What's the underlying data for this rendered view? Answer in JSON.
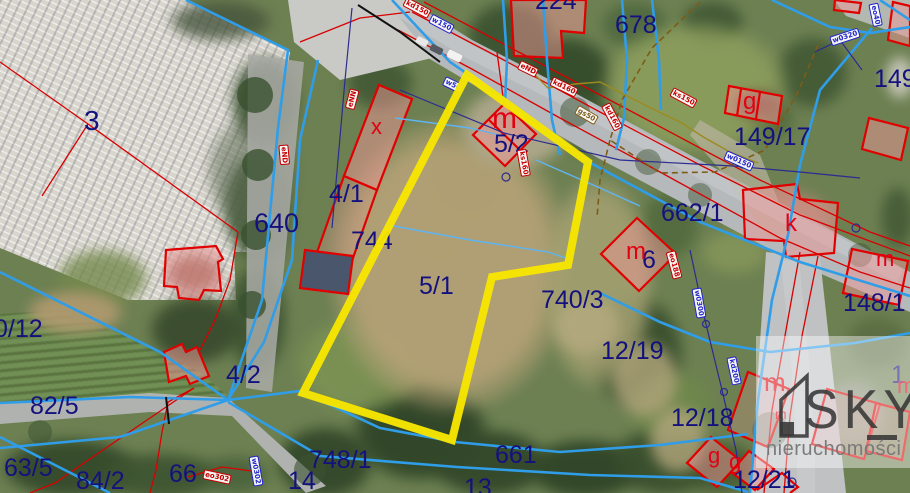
{
  "map": {
    "colors": {
      "parcel_label": "#14117f",
      "building_letter": "#e30011",
      "cadastral_red": "#d80000",
      "utility_blue": "#2f9de8",
      "boundary_brown": "#7d5c17",
      "highlight_yellow": "#f7e600"
    },
    "highlight": {
      "parcel": "5/1",
      "polygon": [
        [
          467,
          75
        ],
        [
          588,
          162
        ],
        [
          568,
          265
        ],
        [
          492,
          277
        ],
        [
          452,
          440
        ],
        [
          303,
          393
        ]
      ]
    },
    "parcel_labels": [
      {
        "text": "3",
        "x": 84,
        "y": 106,
        "size": 28
      },
      {
        "text": "640",
        "x": 254,
        "y": 209,
        "size": 27
      },
      {
        "text": "4/1",
        "x": 329,
        "y": 181
      },
      {
        "text": "744",
        "x": 351,
        "y": 228
      },
      {
        "text": "5/1",
        "x": 419,
        "y": 273
      },
      {
        "text": "5/2",
        "x": 494,
        "y": 131
      },
      {
        "text": "224",
        "x": 535,
        "y": -12
      },
      {
        "text": "678",
        "x": 615,
        "y": 12
      },
      {
        "text": "149",
        "x": 874,
        "y": 66
      },
      {
        "text": "149/17",
        "x": 734,
        "y": 124
      },
      {
        "text": "662/1",
        "x": 661,
        "y": 200
      },
      {
        "text": "6",
        "x": 642,
        "y": 247
      },
      {
        "text": "740/3",
        "x": 541,
        "y": 287
      },
      {
        "text": "12/19",
        "x": 601,
        "y": 338
      },
      {
        "text": "148/1",
        "x": 843,
        "y": 290
      },
      {
        "text": "12/18",
        "x": 671,
        "y": 405
      },
      {
        "text": "12/21",
        "x": 733,
        "y": 467
      },
      {
        "text": "1",
        "x": 891,
        "y": 362
      },
      {
        "text": "0/12",
        "x": -6,
        "y": 316
      },
      {
        "text": "82/5",
        "x": 30,
        "y": 393
      },
      {
        "text": "63/5",
        "x": 4,
        "y": 455
      },
      {
        "text": "84/2",
        "x": 76,
        "y": 468
      },
      {
        "text": "66",
        "x": 169,
        "y": 461
      },
      {
        "text": "4/2",
        "x": 226,
        "y": 362
      },
      {
        "text": "748/1",
        "x": 309,
        "y": 447
      },
      {
        "text": "14",
        "x": 288,
        "y": 468
      },
      {
        "text": "13",
        "x": 464,
        "y": 475
      },
      {
        "text": "661",
        "x": 495,
        "y": 442
      }
    ],
    "building_letters": [
      {
        "text": "x",
        "x": 371,
        "y": 116,
        "size": 22
      },
      {
        "text": "m",
        "x": 492,
        "y": 104,
        "size": 30
      },
      {
        "text": "m",
        "x": 626,
        "y": 240,
        "size": 24
      },
      {
        "text": "g",
        "x": 743,
        "y": 90,
        "size": 24
      },
      {
        "text": "k",
        "x": 785,
        "y": 212,
        "size": 24
      },
      {
        "text": "m",
        "x": 876,
        "y": 248,
        "size": 22
      },
      {
        "text": "m",
        "x": 764,
        "y": 369,
        "size": 26
      },
      {
        "text": "m",
        "x": 775,
        "y": 407,
        "size": 14
      },
      {
        "text": "m",
        "x": 897,
        "y": 375,
        "size": 22
      },
      {
        "text": "g",
        "x": 708,
        "y": 445,
        "size": 22
      },
      {
        "text": "g",
        "x": 729,
        "y": 451,
        "size": 22
      }
    ],
    "utility_labels": [
      {
        "text": "kd150",
        "x": 403,
        "y": 3,
        "rot": 28,
        "color": "red"
      },
      {
        "text": "w150",
        "x": 429,
        "y": 19,
        "rot": 28,
        "color": "blue"
      },
      {
        "text": "w50",
        "x": 443,
        "y": 80,
        "rot": 26,
        "color": "blue"
      },
      {
        "text": "eND",
        "x": 518,
        "y": 64,
        "rot": 26,
        "color": "red"
      },
      {
        "text": "kd160",
        "x": 550,
        "y": 82,
        "rot": 26,
        "color": "red"
      },
      {
        "text": "ks150",
        "x": 670,
        "y": 93,
        "rot": 28,
        "color": "red"
      },
      {
        "text": "kd160",
        "x": 598,
        "y": 112,
        "rot": 62,
        "color": "red"
      },
      {
        "text": "w0150",
        "x": 724,
        "y": 156,
        "rot": 24,
        "color": "blue"
      },
      {
        "text": "ks160",
        "x": 510,
        "y": 158,
        "rot": 80,
        "color": "red"
      },
      {
        "text": "gs50",
        "x": 575,
        "y": 110,
        "rot": 30,
        "color": "brown"
      },
      {
        "text": "w0320",
        "x": 830,
        "y": 32,
        "rot": -18,
        "color": "blue"
      },
      {
        "text": "eo40",
        "x": 864,
        "y": 10,
        "rot": 78,
        "color": "blue"
      },
      {
        "text": "eNN",
        "x": 342,
        "y": 94,
        "rot": -75,
        "color": "red"
      },
      {
        "text": "eND",
        "x": 274,
        "y": 150,
        "rot": 85,
        "color": "red"
      },
      {
        "text": "eo302",
        "x": 203,
        "y": 472,
        "rot": 12,
        "color": "red"
      },
      {
        "text": "w0302",
        "x": 241,
        "y": 466,
        "rot": 80,
        "color": "blue"
      },
      {
        "text": "eo188",
        "x": 660,
        "y": 260,
        "rot": 75,
        "color": "red"
      },
      {
        "text": "w0300",
        "x": 684,
        "y": 298,
        "rot": 80,
        "color": "blue"
      },
      {
        "text": "kd200",
        "x": 720,
        "y": 366,
        "rot": 78,
        "color": "blue"
      }
    ]
  },
  "watermark": {
    "brand": "SKY",
    "subtitle": "nieruchomości"
  }
}
